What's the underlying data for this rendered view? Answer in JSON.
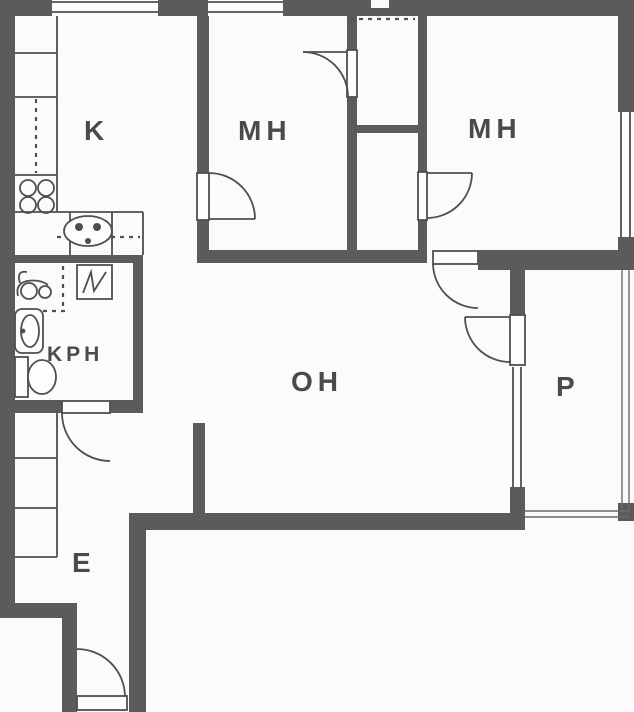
{
  "colors": {
    "wall": "#5b5b5b",
    "line": "#4f4f4f",
    "label": "#4a4a4a",
    "background": "#fbfbfb"
  },
  "rooms": [
    {
      "key": "kitchen",
      "label": "K"
    },
    {
      "key": "bedroom-1",
      "label": "MH"
    },
    {
      "key": "bedroom-2",
      "label": "MH"
    },
    {
      "key": "living-room",
      "label": "OH"
    },
    {
      "key": "bathroom",
      "label": "KPH"
    },
    {
      "key": "entrance",
      "label": "E"
    },
    {
      "key": "balcony",
      "label": "P"
    }
  ],
  "fixtures": [
    "stove-icon",
    "kitchen-sink-icon",
    "washing-machine-icon",
    "water-heater-icon",
    "washbasin-icon",
    "toilet-icon",
    "kitchen-cabinets",
    "entrance-closets",
    "wardrobe-bedroom-1",
    "wardrobe-bedroom-2"
  ]
}
